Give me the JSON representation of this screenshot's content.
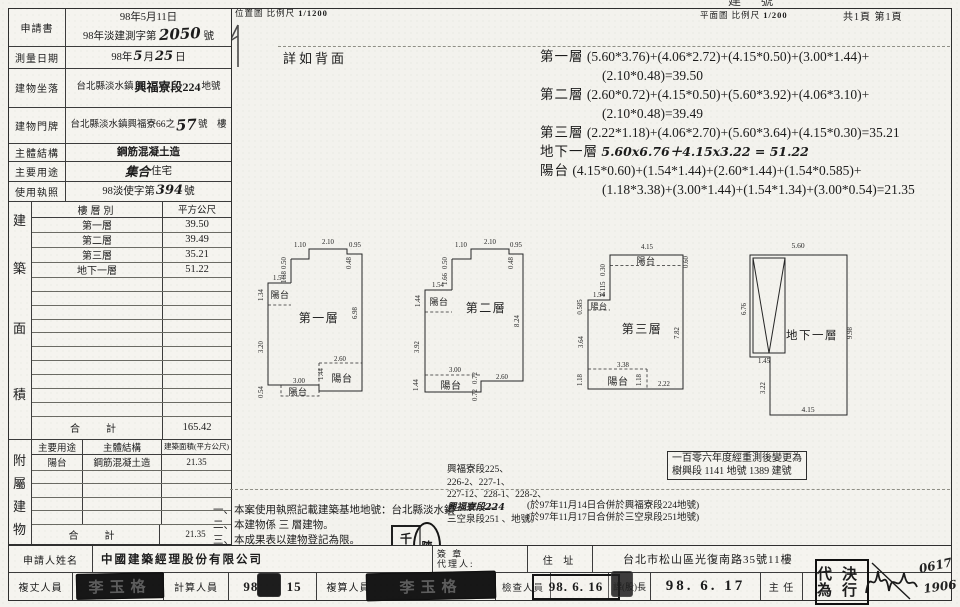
{
  "top": {
    "cutoff": "建 號",
    "loc_map": "位置圖",
    "loc_scale_label": "比例尺",
    "loc_scale": "1/1200",
    "see_back": "詳如背面",
    "plan_map": "平面圖",
    "plan_scale_label": "比例尺",
    "plan_scale": "1/200",
    "pages": "共1頁 第1頁"
  },
  "form": {
    "application_label": "申請書",
    "application_date": "98年5月11日",
    "application_no_prefix": "98年淡建測字第",
    "application_no": "2050",
    "application_no_suffix": "號",
    "survey_date_label": "測量日期",
    "survey_date_prefix": "98年",
    "survey_month": "5",
    "survey_month_suffix": "月",
    "survey_day": "25",
    "survey_day_suffix": "日",
    "location_label": "建物坐落",
    "location_city": "台北縣淡水鎮",
    "location_section": "興福寮段224",
    "location_suffix": "地號",
    "door_label": "建物門牌",
    "door_prefix": "台北縣淡水鎮興福寮66之",
    "door_no": "57",
    "door_suffix": "號　樓",
    "structure_label": "主體結構",
    "structure_value": "鋼筋混凝土造",
    "usage_label": "主要用途",
    "usage_hand": "集合",
    "usage_print": "住宅",
    "license_label": "使用執照",
    "license_prefix": "98淡使字第",
    "license_no": "394",
    "license_suffix": "號"
  },
  "area": {
    "side_chars": [
      "建",
      "築",
      "面",
      "積"
    ],
    "col_floor": "樓層別",
    "col_sqm": "平方公尺",
    "rows": [
      {
        "floor": "第一層",
        "sqm": "39.50"
      },
      {
        "floor": "第二層",
        "sqm": "39.49"
      },
      {
        "floor": "第三層",
        "sqm": "35.21"
      },
      {
        "floor": "地下一層",
        "sqm": "51.22"
      }
    ],
    "total_label": "合　計",
    "total": "165.42"
  },
  "annex": {
    "side_chars": [
      "附",
      "屬",
      "建",
      "物"
    ],
    "col_usage": "主要用途",
    "col_structure": "主體結構",
    "col_area": "建築面積(平方公尺)",
    "rows": [
      {
        "usage": "陽台",
        "structure": "鋼筋混凝土造",
        "area": "21.35"
      }
    ],
    "total_label": "合　計",
    "total": "21.35"
  },
  "calc": {
    "l1a": "第一層",
    "l1b": "(5.60*3.76)+(4.06*2.72)+(4.15*0.50)+(3.00*1.44)+",
    "l1c": "(2.10*0.48)=39.50",
    "l2a": "第二層",
    "l2b": "(2.60*0.72)+(4.15*0.50)+(5.60*3.92)+(4.06*3.10)+",
    "l2c": "(2.10*0.48)=39.49",
    "l3a": "第三層",
    "l3b": "(2.22*1.18)+(4.06*2.70)+(5.60*3.64)+(4.15*0.30)=35.21",
    "l4a": "地下一層",
    "l4b": "5.60x6.76＋4.15x3.22 = 51.22",
    "l5a": "陽台",
    "l5b": "(4.15*0.60)+(1.54*1.44)+(2.60*1.44)+(1.54*0.585)+",
    "l5c": "(1.18*3.38)+(3.00*1.44)+(1.54*1.34)+(3.00*0.54)=21.35"
  },
  "plans": [
    {
      "title": "第一層",
      "balcony_tl": "陽台",
      "balcony_br": "陽台",
      "balcony_bl": "陽台",
      "d_top_a": "1.10",
      "d_top_b": "2.10",
      "d_top_c": "0.48",
      "d_top_d": "0.95",
      "d_l_a": "0.50",
      "d_l_b": "1.38",
      "d_l_c": "1.54",
      "d_l_d": "1.34",
      "d_l_e": "3.20",
      "d_l_f": "0.54",
      "d_r": "6.98",
      "d_b_a": "3.00",
      "d_b_b": "2.60",
      "d_b_c": "1.44"
    },
    {
      "title": "第二層",
      "balcony_tl": "陽台",
      "balcony_b": "陽台",
      "d_top_a": "1.10",
      "d_top_b": "2.10",
      "d_top_c": "0.48",
      "d_top_d": "0.95",
      "d_l_a": "0.50",
      "d_l_b": "1.66",
      "d_l_c": "1.54",
      "d_l_d": "1.44",
      "d_l_e": "3.92",
      "d_l_f": "1.44",
      "d_r": "8.24",
      "d_b_a": "3.00",
      "d_b_b": "2.60",
      "d_b_c": "0.72",
      "d_b_d": "0.72"
    },
    {
      "title": "第三層",
      "balcony_t": "陽台",
      "balcony_l": "陽台",
      "balcony_b": "陽台",
      "d_top_a": "4.15",
      "d_r_a": "0.60",
      "d_l_a": "0.30",
      "d_l_b": "2.115",
      "d_l_c": "1.54",
      "d_l_d": "0.585",
      "d_l_e": "3.64",
      "d_l_f": "1.18",
      "d_r": "7.82",
      "d_b_a": "3.38",
      "d_b_b": "1.18",
      "d_b_c": "2.22"
    },
    {
      "title": "地下一層",
      "d_top": "5.60",
      "d_l_a": "6.76",
      "d_l_b": "1.45",
      "d_l_c": "3.22",
      "d_r": "9.98",
      "d_b": "4.15"
    }
  ],
  "notes": {
    "n1": "一、本案使用執照記載建築基地地號：台北縣淡水鎮",
    "n2": "二、本建物係 三 層建物。",
    "n3": "三、本成果表以建物登記為限。",
    "parcels": [
      "興福寮段225、",
      "226-2、227-1、",
      "227-12、228-1、228-2、",
      "興福寮段224",
      "三空泉段251 、地號。"
    ],
    "merge1": "(於97年11月14日合併於興福寮段224地號)",
    "merge2": "(於97年11月17日合併於三空泉段251地號)",
    "box_l1": "一百零六年度經重測後變更為",
    "box_l2": "樹興段 1141 地號 1389 建號"
  },
  "footer": {
    "applicant_label": "申請人姓名",
    "applicant": "中國建築經理股份有限公司",
    "sign_label": "簽 章",
    "agent_label": "代理人:",
    "addr_label": "住 址",
    "addr": "台北市松山區光復南路35號11樓",
    "survey_label": "複丈人員",
    "stamp1": "李玉格",
    "calc_label": "計算人員",
    "date1_a": "98.",
    "date1_b": "15",
    "recheck_label": "複算人員",
    "stamp2": "李玉格",
    "check_label": "檢查人員",
    "date2": "98. 6. 16",
    "chief_label": "課(股)長",
    "date3": "98. 6. 17",
    "director_label": "主 任",
    "proxy_r1": "代為",
    "proxy_r2": "決行",
    "sig1": "0617",
    "sig2": "1906"
  },
  "seals": {
    "square_top": "千",
    "square_bottom": "技",
    "oval": "陳"
  }
}
